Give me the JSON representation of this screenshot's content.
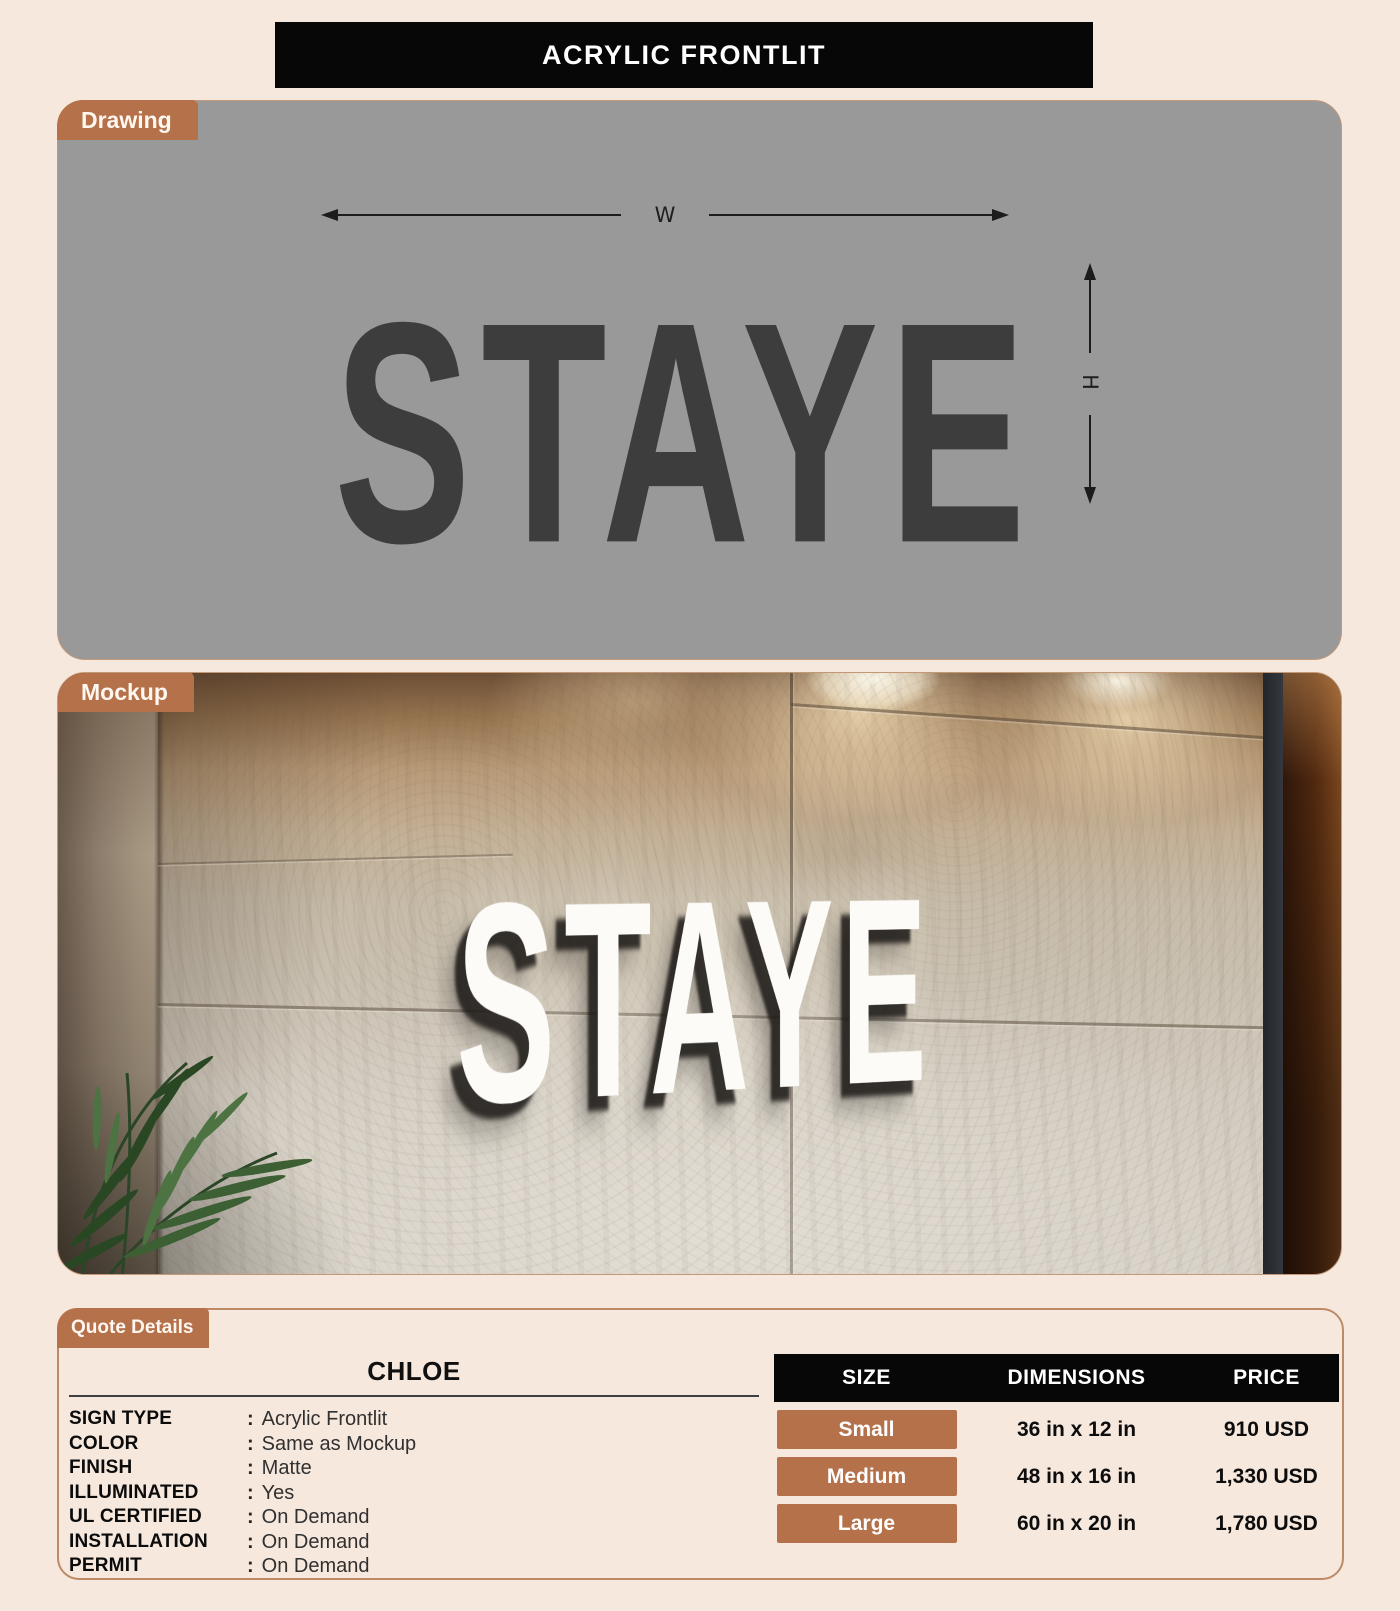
{
  "colors": {
    "background": "#f7e8de",
    "accent_brown": "#b4714a",
    "panel_gray": "#9a999a",
    "banner_black": "#070707",
    "drawing_text": "#3d3d3d",
    "mockup_sign": "#fcfbf8"
  },
  "header": {
    "title": "ACRYLIC FRONTLIT"
  },
  "drawing": {
    "tag": "Drawing",
    "sign_text": "STAYE",
    "width_label": "W",
    "height_label": "H"
  },
  "mockup": {
    "tag": "Mockup",
    "sign_text": "STAYE"
  },
  "quote": {
    "tag": "Quote Details",
    "name": "CHLOE",
    "separator": ":",
    "specs": [
      {
        "label": "SIGN TYPE",
        "value": "Acrylic Frontlit"
      },
      {
        "label": "COLOR",
        "value": "Same as Mockup"
      },
      {
        "label": "FINISH",
        "value": "Matte"
      },
      {
        "label": "ILLUMINATED",
        "value": "Yes"
      },
      {
        "label": "UL CERTIFIED",
        "value": "On Demand"
      },
      {
        "label": "INSTALLATION",
        "value": "On Demand"
      },
      {
        "label": "PERMIT",
        "value": "On Demand"
      }
    ],
    "table": {
      "headers": [
        "SIZE",
        "DIMENSIONS",
        "PRICE"
      ],
      "rows": [
        {
          "size": "Small",
          "dimensions": "36 in x 12 in",
          "price": "910 USD"
        },
        {
          "size": "Medium",
          "dimensions": "48 in x 16 in",
          "price": "1,330 USD"
        },
        {
          "size": "Large",
          "dimensions": "60 in x 20 in",
          "price": "1,780 USD"
        }
      ]
    }
  }
}
